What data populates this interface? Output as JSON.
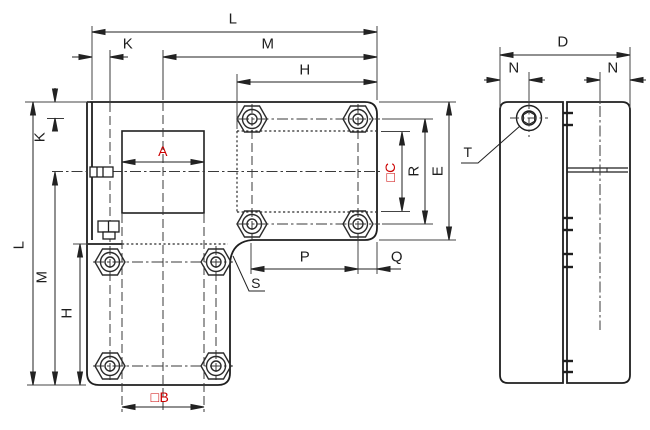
{
  "drawing": {
    "kind": "technical dimension drawing",
    "background_color": "#ffffff",
    "line_color": "#2b2b2b",
    "accent_color": "#cc0000"
  },
  "labels": {
    "L_top": "L",
    "K_top": "K",
    "M_top": "M",
    "H_top": "H",
    "L_left": "L",
    "K_left": "K",
    "M_left": "M",
    "H_left": "H",
    "A": "A",
    "B": "□B",
    "C": "□C",
    "R": "R",
    "E": "E",
    "P": "P",
    "Q": "Q",
    "S": "S",
    "T": "T",
    "D": "D",
    "N_left": "N",
    "N_right": "N"
  }
}
